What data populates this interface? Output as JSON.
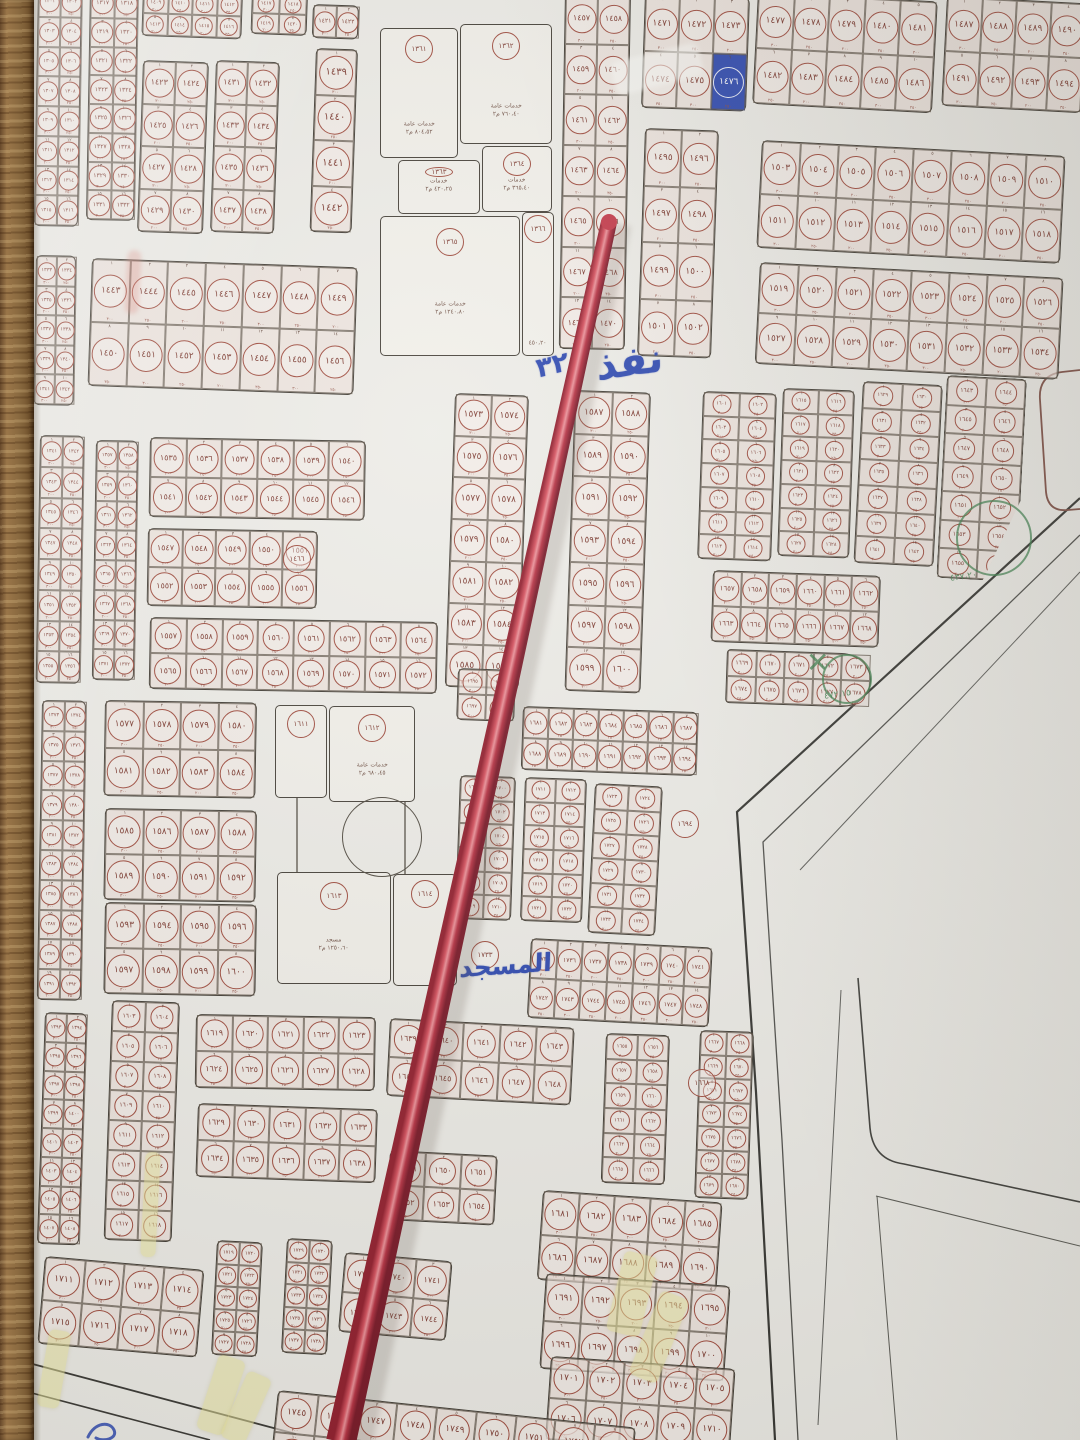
{
  "meta": {
    "kind": "photograph of printed cadastral subdivision map on wall",
    "language": "ar",
    "script_digits": "arabic-indic"
  },
  "palette": {
    "paper": "#ecebe6",
    "ink": "#39342c",
    "circle": "#9c4638",
    "num": "#7a362c",
    "blue": "#2743ae",
    "green": "#3a7d4a",
    "tape": "#e9e49a",
    "stick": "#b32a3c",
    "wood": "#8d6e47"
  },
  "map": {
    "cell_sub_labels": [
      "٣٠٠",
      "٢٥٠",
      "٢٠٠",
      "٣٥٠"
    ],
    "blocks": [
      {
        "id": "L1",
        "x": 38,
        "y": -14,
        "cols": 2,
        "rows": 8,
        "cw": 22,
        "ch": 30,
        "rot": 1,
        "start": 1301
      },
      {
        "id": "L1b",
        "x": 90,
        "y": -12,
        "cols": 2,
        "rows": 8,
        "cw": 24,
        "ch": 29,
        "rot": 1,
        "start": 1317
      },
      {
        "id": "L2",
        "x": 36,
        "y": 255,
        "cols": 2,
        "rows": 5,
        "cw": 20,
        "ch": 30,
        "rot": 1,
        "start": 1333
      },
      {
        "id": "L3",
        "x": 40,
        "y": 435,
        "cols": 2,
        "rows": 8,
        "cw": 22,
        "ch": 31,
        "rot": 1,
        "start": 1341
      },
      {
        "id": "L3b",
        "x": 96,
        "y": 440,
        "cols": 2,
        "rows": 8,
        "cw": 21,
        "ch": 30,
        "rot": 1,
        "start": 1357
      },
      {
        "id": "L4",
        "x": 42,
        "y": 700,
        "cols": 2,
        "rows": 10,
        "cw": 22,
        "ch": 30,
        "rot": 1,
        "start": 1373
      },
      {
        "id": "L5",
        "x": 45,
        "y": 1012,
        "cols": 2,
        "rows": 8,
        "cw": 21,
        "ch": 29,
        "rot": 2,
        "start": 1393
      },
      {
        "id": "T1",
        "x": 143,
        "y": -10,
        "cols": 4,
        "rows": 2,
        "cw": 25,
        "ch": 23,
        "rot": 2,
        "start": 1409
      },
      {
        "id": "T2",
        "x": 252,
        "y": -8,
        "cols": 2,
        "rows": 2,
        "cw": 28,
        "ch": 21,
        "rot": 2,
        "start": 1417
      },
      {
        "id": "T2b",
        "x": 313,
        "y": 4,
        "cols": 2,
        "rows": 1,
        "cw": 23,
        "ch": 34,
        "rot": 2,
        "start": 1421
      },
      {
        "id": "T3",
        "x": 143,
        "y": 60,
        "cols": 2,
        "rows": 4,
        "cw": 33,
        "ch": 43,
        "rot": 2,
        "start": 1423
      },
      {
        "id": "T6",
        "x": 216,
        "y": 60,
        "cols": 2,
        "rows": 4,
        "cw": 32,
        "ch": 43,
        "rot": 2,
        "start": 1431
      },
      {
        "id": "T8",
        "x": 316,
        "y": 48,
        "cols": 1,
        "rows": 4,
        "cw": 42,
        "ch": 46,
        "rot": 2,
        "start": 1439
      },
      {
        "id": "T4",
        "x": 92,
        "y": 258,
        "cols": 7,
        "rows": 2,
        "cw": 38,
        "ch": 64,
        "rot": 2,
        "start": 1443
      },
      {
        "id": "C2",
        "x": 565,
        "y": -8,
        "cols": 2,
        "rows": 7,
        "cw": 33,
        "ch": 51,
        "rot": 1,
        "start": 1457
      },
      {
        "id": "C3",
        "x": 645,
        "y": -6,
        "cols": 3,
        "rows": 2,
        "cw": 35,
        "ch": 57,
        "rot": 2,
        "start": 1471
      },
      {
        "id": "C4",
        "x": 758,
        "y": -8,
        "cols": 5,
        "rows": 2,
        "cw": 36,
        "ch": 56,
        "rot": 3,
        "start": 1477
      },
      {
        "id": "C5",
        "x": 947,
        "y": -4,
        "cols": 4,
        "rows": 2,
        "cw": 35,
        "ch": 55,
        "rot": 3,
        "start": 1487
      },
      {
        "id": "C6",
        "x": 645,
        "y": 128,
        "cols": 2,
        "rows": 4,
        "cw": 37,
        "ch": 57,
        "rot": 2,
        "start": 1495
      },
      {
        "id": "C7",
        "x": 762,
        "y": 140,
        "cols": 8,
        "rows": 2,
        "cw": 38,
        "ch": 54,
        "rot": 3,
        "start": 1503
      },
      {
        "id": "C8",
        "x": 760,
        "y": 262,
        "cols": 8,
        "rows": 2,
        "cw": 38,
        "ch": 51,
        "rot": 3,
        "start": 1519
      },
      {
        "id": "M1",
        "x": 150,
        "y": 437,
        "cols": 6,
        "rows": 2,
        "cw": 36,
        "ch": 40,
        "rot": 1,
        "start": 1535
      },
      {
        "id": "M2",
        "x": 148,
        "y": 528,
        "cols": 5,
        "rows": 2,
        "cw": 34,
        "ch": 39,
        "rot": 1,
        "start": 1547
      },
      {
        "id": "M3",
        "x": 150,
        "y": 617,
        "cols": 8,
        "rows": 2,
        "cw": 36,
        "ch": 36,
        "rot": 1,
        "start": 1557
      },
      {
        "id": "M4",
        "x": 455,
        "y": 393,
        "cols": 2,
        "rows": 7,
        "cw": 37,
        "ch": 42,
        "rot": 2,
        "start": 1573
      },
      {
        "id": "M5",
        "x": 575,
        "y": 390,
        "cols": 2,
        "rows": 7,
        "cw": 38,
        "ch": 43,
        "rot": 2,
        "start": 1587
      },
      {
        "id": "R1",
        "x": 703,
        "y": 391,
        "cols": 2,
        "rows": 7,
        "cw": 37,
        "ch": 24,
        "rot": 2,
        "start": 1601
      },
      {
        "id": "R2",
        "x": 783,
        "y": 388,
        "cols": 2,
        "rows": 7,
        "cw": 36,
        "ch": 24,
        "rot": 2,
        "start": 1615
      },
      {
        "id": "R3",
        "x": 863,
        "y": 381,
        "cols": 2,
        "rows": 7,
        "cw": 40,
        "ch": 26,
        "rot": 3,
        "start": 1629
      },
      {
        "id": "R4",
        "x": 947,
        "y": 375,
        "cols": 2,
        "rows": 7,
        "cw": 40,
        "ch": 29,
        "rot": 3,
        "start": 1643,
        "clip": "polygon(0 0,100% 0,100% 60%,58% 100%,0 100%)"
      },
      {
        "id": "R5",
        "x": 713,
        "y": 570,
        "cols": 6,
        "rows": 2,
        "cw": 28,
        "ch": 36,
        "rot": 2,
        "start": 1657
      },
      {
        "id": "R6",
        "x": 727,
        "y": 649,
        "cols": 5,
        "rows": 2,
        "cw": 29,
        "ch": 27,
        "rot": 2,
        "start": 1669,
        "radius": "4px 30px 30px 4px / 4px 50% 50% 4px"
      },
      {
        "id": "K1",
        "x": 105,
        "y": 700,
        "cols": 4,
        "rows": 2,
        "cw": 38,
        "ch": 48,
        "rot": 1,
        "start": 1577
      },
      {
        "id": "K2",
        "x": 105,
        "y": 808,
        "cols": 4,
        "rows": 2,
        "cw": 38,
        "ch": 46,
        "rot": 1,
        "start": 1585
      },
      {
        "id": "K3",
        "x": 105,
        "y": 902,
        "cols": 4,
        "rows": 2,
        "cw": 38,
        "ch": 46,
        "rot": 1,
        "start": 1593
      },
      {
        "id": "N1",
        "x": 523,
        "y": 706,
        "cols": 7,
        "rows": 2,
        "cw": 25,
        "ch": 32,
        "rot": 2,
        "start": 1681
      },
      {
        "id": "N2a",
        "x": 458,
        "y": 668,
        "cols": 2,
        "rows": 2,
        "cw": 29,
        "ch": 26,
        "rot": 2,
        "start": 1695
      },
      {
        "id": "N2",
        "x": 460,
        "y": 775,
        "cols": 2,
        "rows": 6,
        "cw": 28,
        "ch": 24,
        "rot": 2,
        "start": 1699
      },
      {
        "id": "N3",
        "x": 525,
        "y": 777,
        "cols": 2,
        "rows": 6,
        "cw": 31,
        "ch": 24,
        "rot": 2,
        "start": 1711
      },
      {
        "id": "N4",
        "x": 595,
        "y": 783,
        "cols": 2,
        "rows": 6,
        "cw": 34,
        "ch": 25,
        "rot": 3,
        "start": 1723
      },
      {
        "id": "N5",
        "x": 531,
        "y": 938,
        "cols": 7,
        "rows": 2,
        "cw": 26,
        "ch": 40,
        "rot": 3,
        "start": 1735
      },
      {
        "id": "Q2",
        "x": 112,
        "y": 1000,
        "cols": 2,
        "rows": 8,
        "cw": 34,
        "ch": 30,
        "rot": 2,
        "start": 1603
      },
      {
        "id": "Q3",
        "x": 196,
        "y": 1014,
        "cols": 5,
        "rows": 2,
        "cw": 36,
        "ch": 37,
        "rot": 1,
        "start": 1619
      },
      {
        "id": "Q4",
        "x": 198,
        "y": 1103,
        "cols": 5,
        "rows": 2,
        "cw": 36,
        "ch": 37,
        "rot": 2,
        "start": 1629
      },
      {
        "id": "Q6",
        "x": 390,
        "y": 1018,
        "cols": 5,
        "rows": 2,
        "cw": 37,
        "ch": 39,
        "rot": 3,
        "start": 1639
      },
      {
        "id": "Q7",
        "x": 390,
        "y": 1150,
        "cols": 3,
        "rows": 2,
        "cw": 36,
        "ch": 35,
        "rot": 3,
        "start": 1649
      },
      {
        "id": "Q11",
        "x": 606,
        "y": 1033,
        "cols": 2,
        "rows": 6,
        "cw": 32,
        "ch": 25,
        "rot": 2,
        "start": 1655
      },
      {
        "id": "Q12",
        "x": 700,
        "y": 1030,
        "cols": 2,
        "rows": 7,
        "cw": 27,
        "ch": 24,
        "rot": 2,
        "start": 1667
      },
      {
        "id": "Q8",
        "x": 543,
        "y": 1190,
        "cols": 5,
        "rows": 2,
        "cw": 36,
        "ch": 45,
        "rot": 4,
        "start": 1681
      },
      {
        "id": "Q9",
        "x": 546,
        "y": 1273,
        "cols": 5,
        "rows": 2,
        "cw": 37,
        "ch": 48,
        "rot": 4,
        "start": 1691
      },
      {
        "id": "Q10",
        "x": 551,
        "y": 1356,
        "cols": 5,
        "rows": 2,
        "cw": 37,
        "ch": 42,
        "rot": 4,
        "start": 1701
      },
      {
        "id": "Q5",
        "x": 45,
        "y": 1256,
        "cols": 4,
        "rows": 2,
        "cw": 40,
        "ch": 44,
        "rot": 5,
        "start": 1711
      },
      {
        "id": "Q5b",
        "x": 217,
        "y": 1240,
        "cols": 2,
        "rows": 5,
        "cw": 23,
        "ch": 23,
        "rot": 3,
        "start": 1719
      },
      {
        "id": "Q5c",
        "x": 287,
        "y": 1238,
        "cols": 2,
        "rows": 5,
        "cw": 23,
        "ch": 23,
        "rot": 3,
        "start": 1729
      },
      {
        "id": "Q5d",
        "x": 345,
        "y": 1252,
        "cols": 3,
        "rows": 2,
        "cw": 36,
        "ch": 40,
        "rot": 5,
        "start": 1739
      },
      {
        "id": "Q14",
        "x": 278,
        "y": 1390,
        "cols": 9,
        "rows": 2,
        "cw": 40,
        "ch": 42,
        "rot": 6,
        "start": 1745
      }
    ],
    "facility_squares": [
      {
        "id": "S1",
        "plots": [
          {
            "x": 380,
            "y": 28,
            "w": 78,
            "h": 130,
            "n": 1361,
            "lines": [
              "خدمات عامة",
              "٨٠٤،٥٢ م٢"
            ]
          },
          {
            "x": 460,
            "y": 24,
            "w": 92,
            "h": 120,
            "n": 1362,
            "lines": [
              "خدمات عامة",
              "٧٦٠،٤٠ م٢"
            ]
          },
          {
            "x": 398,
            "y": 160,
            "w": 82,
            "h": 54,
            "n": 1363,
            "lines": [
              "خدمات",
              "٤٢٠،٢٥ م٢"
            ]
          },
          {
            "x": 482,
            "y": 146,
            "w": 70,
            "h": 66,
            "n": 1364,
            "lines": [
              "خدمات",
              "٣٦٥،٤٠ م٢"
            ]
          },
          {
            "x": 380,
            "y": 216,
            "w": 140,
            "h": 140,
            "n": 1365,
            "lines": [
              "خدمات عامة",
              "١٢٤٠،٨٠ م٢"
            ]
          },
          {
            "x": 522,
            "y": 212,
            "w": 32,
            "h": 144,
            "n": 1366,
            "lines": [
              "٤٥٠،٢٠"
            ]
          }
        ],
        "circles": []
      },
      {
        "id": "S2",
        "plots": [
          {
            "x": 275,
            "y": 705,
            "w": 52,
            "h": 93,
            "n": 1611,
            "lines": []
          },
          {
            "x": 329,
            "y": 706,
            "w": 86,
            "h": 96,
            "n": 1612,
            "lines": [
              "خدمات عامة",
              "٦٨٠،٤٥ م٢"
            ]
          },
          {
            "x": 277,
            "y": 872,
            "w": 114,
            "h": 112,
            "n": 1613,
            "lines": [
              "مسجد",
              "١٢٥٠،٦٠ م٢"
            ]
          },
          {
            "x": 393,
            "y": 874,
            "w": 64,
            "h": 112,
            "n": 1614,
            "lines": []
          }
        ],
        "circles": [
          {
            "cx": 381,
            "cy": 836,
            "r": 39
          }
        ]
      }
    ],
    "lone_circles": [
      {
        "x": 283,
        "y": 545,
        "n": 1466
      },
      {
        "x": 671,
        "y": 810,
        "n": 1694
      },
      {
        "x": 471,
        "y": 941,
        "n": 1733
      },
      {
        "x": 688,
        "y": 1069,
        "n": 1668
      }
    ]
  },
  "annotations": {
    "handwritten": [
      {
        "text": "نفذ",
        "x": 596,
        "y": 344,
        "size": 40,
        "rot": -8
      },
      {
        "text": "٣٢",
        "x": 534,
        "y": 354,
        "size": 27,
        "rot": -14
      },
      {
        "text": "المسجد",
        "x": 460,
        "y": 954,
        "size": 25,
        "rot": -4
      }
    ],
    "highlight_cell": {
      "block": "C3",
      "cell": 5
    },
    "green": {
      "circles": [
        {
          "x": 956,
          "y": 500,
          "d": 72
        },
        {
          "x": 822,
          "y": 654,
          "d": 46
        }
      ],
      "x_mark": {
        "x": 806,
        "y": 646,
        "size": 28,
        "glyph": "✕"
      },
      "texts": [
        {
          "text": "٤٧٢،١٥",
          "x": 824,
          "y": 690,
          "size": 9
        },
        {
          "text": "٤٣٧،٢٠",
          "x": 950,
          "y": 572,
          "size": 9
        }
      ]
    },
    "tapes": [
      {
        "x": 43,
        "y": 1330,
        "w": 22,
        "h": 78,
        "rot": 10
      },
      {
        "x": 143,
        "y": 1152,
        "w": 15,
        "h": 105,
        "rot": 3
      },
      {
        "x": 207,
        "y": 1356,
        "w": 28,
        "h": 78,
        "rot": 18
      },
      {
        "x": 233,
        "y": 1372,
        "w": 26,
        "h": 72,
        "rot": 24
      },
      {
        "x": 615,
        "y": 1253,
        "w": 34,
        "h": 82,
        "rot": 14
      },
      {
        "x": 644,
        "y": 1292,
        "w": 30,
        "h": 90,
        "rot": 22
      }
    ],
    "smudges": [
      {
        "x": 126,
        "y": 250,
        "w": 14,
        "h": 64,
        "rot": 3,
        "color": "rgba(214,110,100,0.28)"
      },
      {
        "x": 612,
        "y": 52,
        "w": 90,
        "h": 34,
        "rot": -14,
        "color": "rgba(252,252,248,0.55)"
      }
    ]
  },
  "objects": {
    "pointer_stick": {
      "top": [
        609,
        222
      ],
      "bottom": [
        341,
        1442
      ],
      "top_width": 16,
      "bottom_width": 30
    },
    "wall": {
      "side": "left",
      "width": 34
    }
  }
}
